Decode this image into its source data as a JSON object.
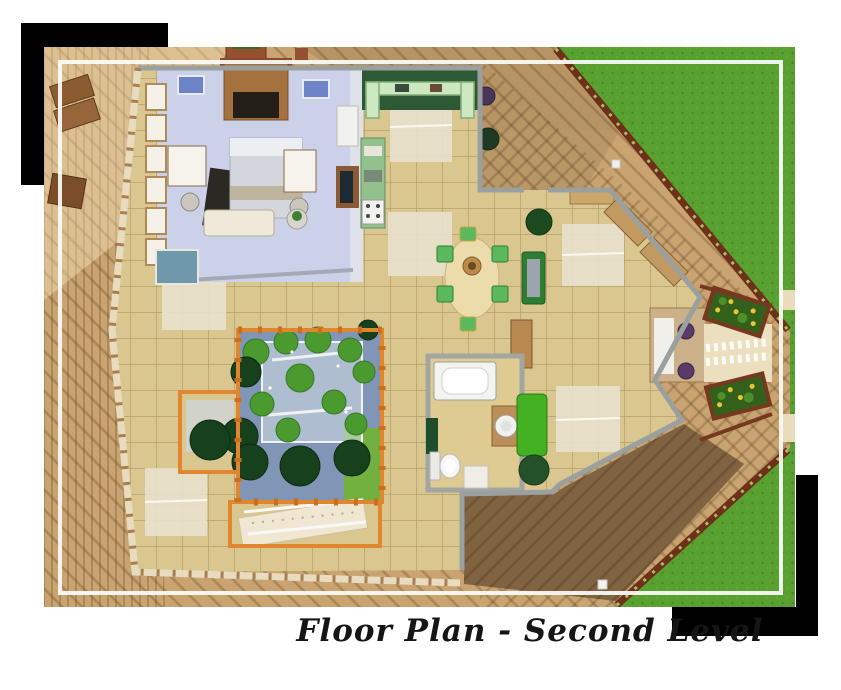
{
  "caption": {
    "text": "Floor Plan - Second Level"
  },
  "colors": {
    "page_background": "#ffffff",
    "black_accent": "#000000",
    "grass": "#58a130",
    "deck_wood": "#c9a470",
    "deck_wood_dark": "#8f6f46",
    "interior_tile": "#d9c78f",
    "bedroom_floor": "#cbd1e9",
    "kitchen_counter_green": "#cde7c0",
    "kitchen_nook_green": "#2d5a35",
    "atrium_water": "#8196b6",
    "fence_orange": "#e0862e",
    "railing_redwood": "#6e3018",
    "sofa_green": "#2e7d32",
    "lounge_green": "#44b122",
    "foliage": "#4a9a30",
    "foliage_dark": "#17401c",
    "flower_yellow": "#e9c832",
    "wall_grey": "#9aa0a0",
    "wall_timber_cream": "#e7dcc0",
    "frame_white": "#fcfcfa",
    "caption_ink": "#151515"
  }
}
